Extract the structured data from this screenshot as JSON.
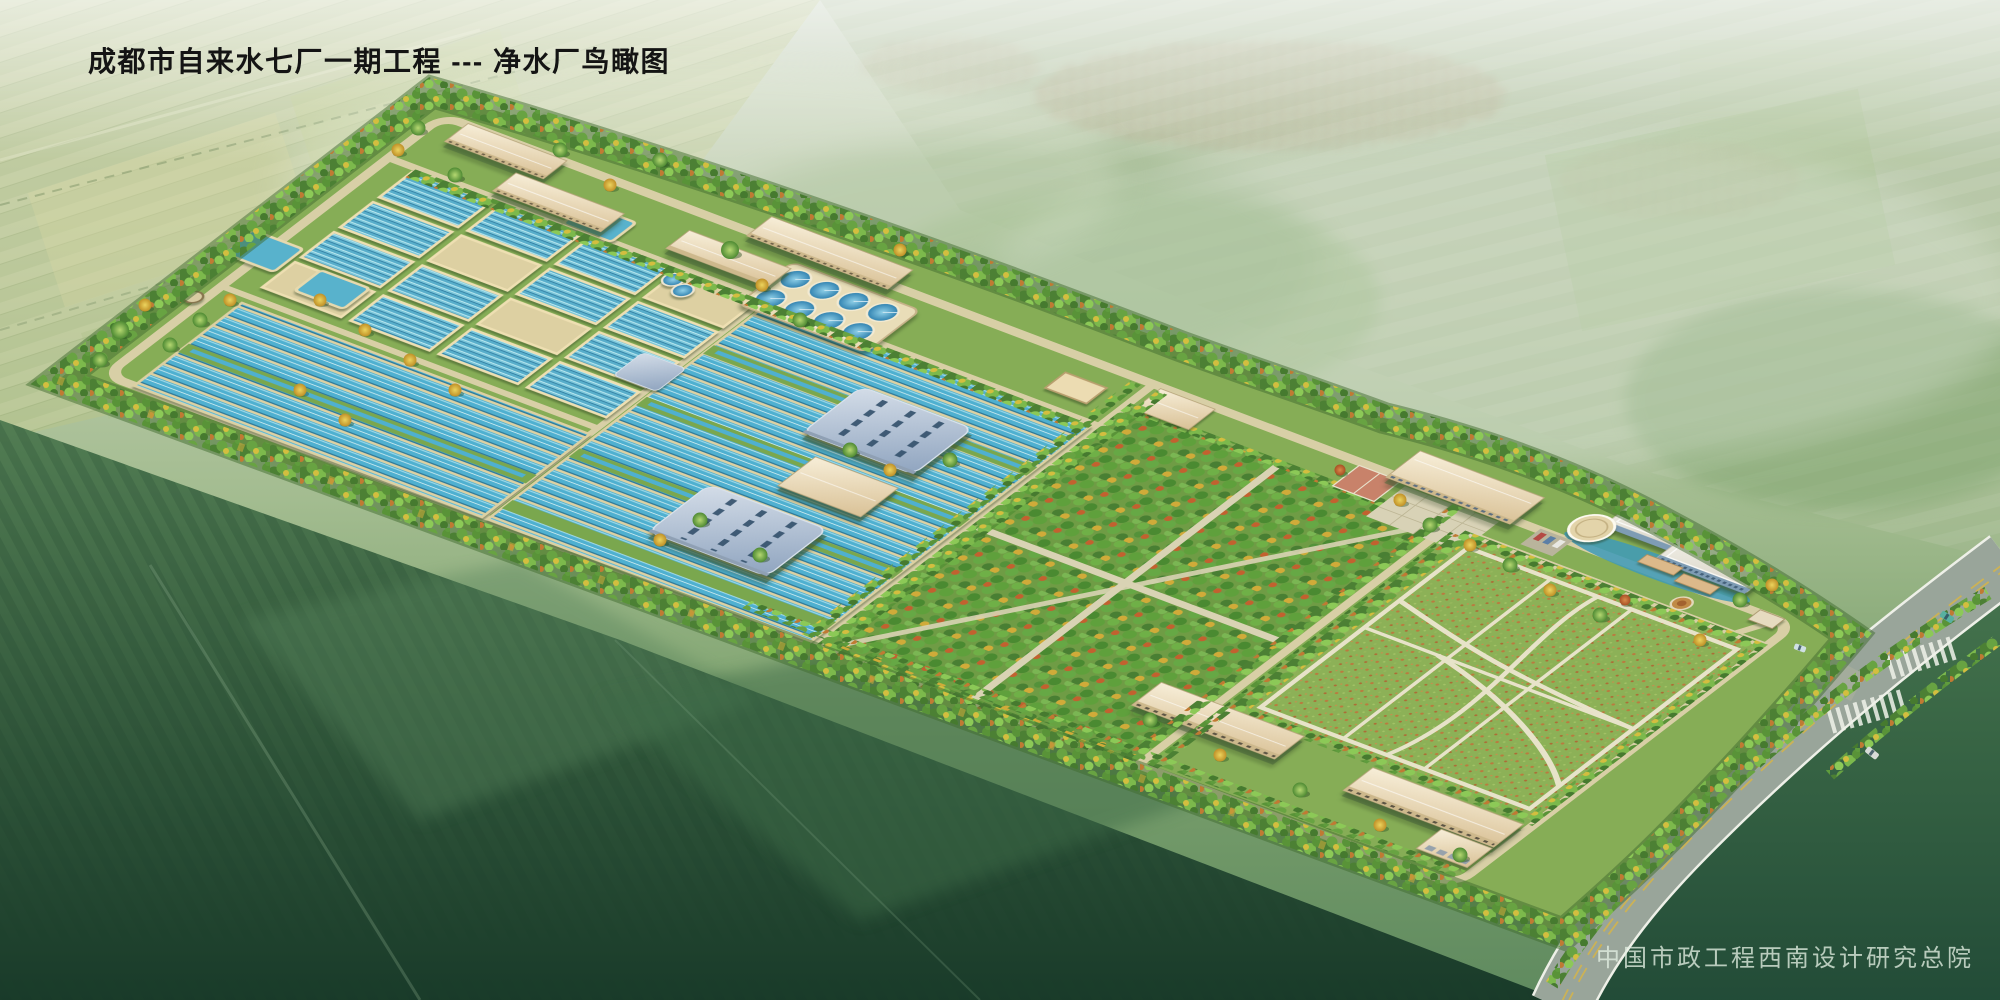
{
  "header": {
    "title": "成都市自来水七厂一期工程 --- 净水厂鸟瞰图"
  },
  "footer": {
    "watermark": "中国市政工程西南设计研究总院"
  },
  "palette": {
    "basin_water": "#4fb0d0",
    "clarifier_water": "#2d7fae",
    "roof_blue": "#9db1c8",
    "roof_beige": "#ead9b4",
    "office_white": "#f3f1e8",
    "vegetation_dark": "#4c8034",
    "vegetation_light": "#8cc957",
    "autumn_yellow": "#d3be3f",
    "autumn_orange": "#c07a33",
    "site_grass": "#86ad56",
    "lawn_speckle": "#bf753c",
    "internal_road": "#d8cfa6",
    "asphalt_road": "#99a59a",
    "road_line_yellow": "#d2b44e",
    "pond_blue": "#3e9ab8",
    "haze_field": "#cfd9c8",
    "foreground_field_dark": "#163727"
  },
  "scene": {
    "type": "aerial-architectural-rendering",
    "elements": [
      "farmland-background",
      "distant-village",
      "mist-haze",
      "plant-site",
      "perimeter-tree-belt",
      "internal-roads",
      "filter-basins",
      "sedimentation-channels",
      "circular-clarifiers",
      "chemical-tanks",
      "small-reservoirs",
      "water-tower",
      "plant-building-a",
      "plant-building-b",
      "plant-building-c",
      "plant-building-d",
      "workshop-building-1",
      "workshop-building-2",
      "pump-house",
      "dosing-building",
      "orchard-grove",
      "garden-pavilion",
      "grove-building",
      "admin-building",
      "admin-plaza",
      "basketball-court",
      "office-building",
      "round-pavilion",
      "landscape-pond",
      "pergola",
      "parking-lot",
      "flower-roundabout",
      "entrance-gate",
      "lawn-field",
      "lawn-paths",
      "dormitory-building-1",
      "dormitory-building-2",
      "garage-building",
      "main-road",
      "crosswalk",
      "vehicles"
    ]
  }
}
